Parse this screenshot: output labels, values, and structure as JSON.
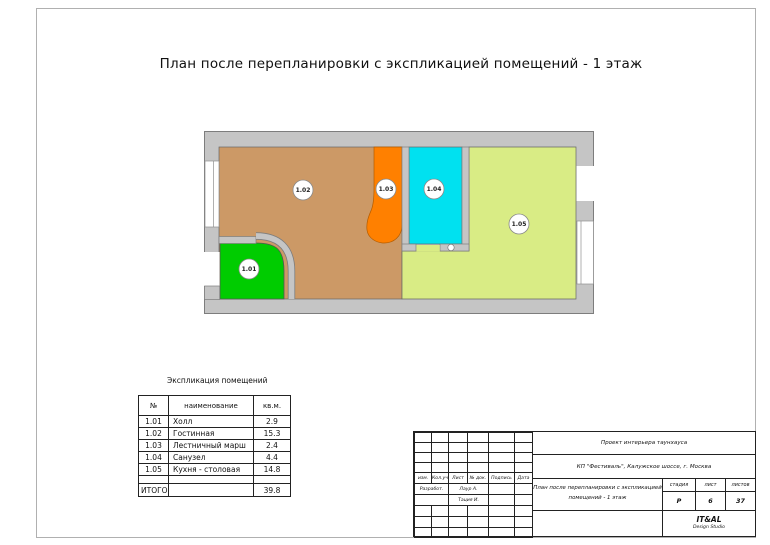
{
  "page": {
    "title": "План после перепланировки с экспликацией помещений - 1 этаж"
  },
  "plan": {
    "wall_color": "#c5c5c5",
    "rooms": [
      {
        "id": "1.01",
        "name": "Холл",
        "area": "2.9",
        "color": "#00cc00"
      },
      {
        "id": "1.02",
        "name": "Гостинная",
        "area": "15.3",
        "color": "#cc9966"
      },
      {
        "id": "1.03",
        "name": "Лестничный марш",
        "area": "2.4",
        "color": "#ff8000"
      },
      {
        "id": "1.04",
        "name": "Санузел",
        "area": "4.4",
        "color": "#00e1f0"
      },
      {
        "id": "1.05",
        "name": "Кухня - столовая",
        "area": "14.8",
        "color": "#d9ec85"
      }
    ]
  },
  "explication": {
    "title": "Экспликация помещений",
    "columns": [
      "№",
      "наименование",
      "кв.м."
    ],
    "total_label": "ИТОГО",
    "total_value": "39.8"
  },
  "stamp": {
    "project": "Проект интерьера таунхауса",
    "address": "КП \"Фестиваль\", Калужское шоссе, г. Москва",
    "doc_title_line1": "План после перепланировки с экспликацией",
    "doc_title_line2": "помещений - 1 этаж",
    "grid_headers": [
      "изм.",
      "Кол.уч",
      "Лист",
      "№ док.",
      "Подпись",
      "Дата"
    ],
    "developer_label": "Разработ.",
    "name1": "Лаур А.",
    "name2": "Тация И.",
    "stage_label": "стадия",
    "sheet_label": "лист",
    "sheets_label": "листов",
    "stage": "Р",
    "sheet": "6",
    "sheets": "37",
    "studio_name": "IT&AL",
    "studio_sub": "Design Studio"
  }
}
